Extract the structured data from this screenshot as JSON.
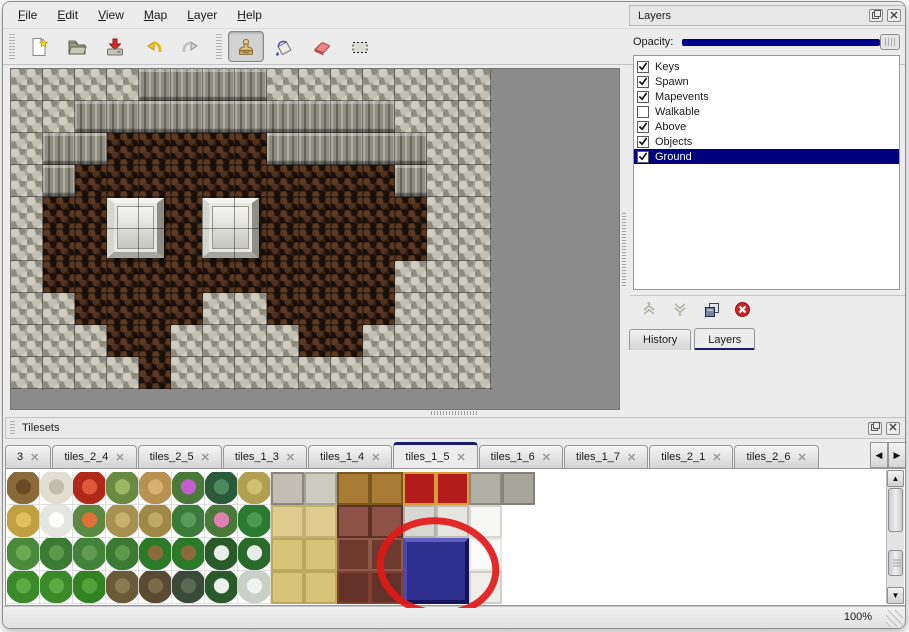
{
  "menu": {
    "items": [
      "File",
      "Edit",
      "View",
      "Map",
      "Layer",
      "Help"
    ]
  },
  "toolbar": {
    "buttons": [
      {
        "id": "new",
        "icon": "new-file-icon",
        "active": false
      },
      {
        "id": "open",
        "icon": "open-folder-icon",
        "active": false
      },
      {
        "id": "save",
        "icon": "save-icon",
        "active": false
      },
      {
        "id": "undo",
        "icon": "undo-icon",
        "active": false
      },
      {
        "id": "redo",
        "icon": "redo-icon",
        "active": false
      },
      {
        "id": "stamp",
        "icon": "stamp-tool-icon",
        "active": true
      },
      {
        "id": "fill",
        "icon": "fill-bucket-icon",
        "active": false
      },
      {
        "id": "eraser",
        "icon": "eraser-icon",
        "active": false
      },
      {
        "id": "select",
        "icon": "select-rect-icon",
        "active": false
      }
    ]
  },
  "map_view": {
    "tile_size": 32,
    "legend": {
      "R": "rock",
      "C": "cliff-face",
      "F": "cave-floor"
    },
    "grid": [
      "RRRRCCCCRRRRRRR",
      "RRCCCCCCCCCCRRR",
      "RCCFFFFFCCCCCRR",
      "RCFFFFFFFFFFCRR",
      "RFFFFFFFFFFFFRR",
      "RFFFFFFFFFFFFRR",
      "RFFFFFFFFFFFRRR",
      "RRFFFFRRFFFFRRR",
      "RRRFFRRRRFFRRRR",
      "RRRRFRRRRRRRRRR"
    ],
    "blocks": [
      {
        "x": 96,
        "y": 129,
        "w": 57,
        "h": 60
      },
      {
        "x": 191,
        "y": 129,
        "w": 57,
        "h": 60
      }
    ],
    "colors": {
      "rock": "#a5a396",
      "cliff": "#8f8d80",
      "floor": "#2e1c12",
      "canvas_bg": "#8b8b8b"
    }
  },
  "layers_panel": {
    "title": "Layers",
    "opacity_label": "Opacity:",
    "opacity_percent": 100,
    "slider_color": "#00008c",
    "selection_color": "#00007f",
    "layers": [
      {
        "name": "Keys",
        "checked": true,
        "selected": false
      },
      {
        "name": "Spawn",
        "checked": true,
        "selected": false
      },
      {
        "name": "Mapevents",
        "checked": true,
        "selected": false
      },
      {
        "name": "Walkable",
        "checked": false,
        "selected": false
      },
      {
        "name": "Above",
        "checked": true,
        "selected": false
      },
      {
        "name": "Objects",
        "checked": true,
        "selected": false
      },
      {
        "name": "Ground",
        "checked": true,
        "selected": true
      }
    ],
    "actions": [
      "move-layer-up",
      "move-layer-down",
      "duplicate-layer",
      "delete-layer"
    ],
    "dock_tabs": [
      {
        "label": "History",
        "active": false
      },
      {
        "label": "Layers",
        "active": true
      }
    ]
  },
  "tilesets_panel": {
    "title": "Tilesets",
    "tabs": [
      {
        "label": "3",
        "active": false
      },
      {
        "label": "tiles_2_4",
        "active": false
      },
      {
        "label": "tiles_2_5",
        "active": false
      },
      {
        "label": "tiles_1_3",
        "active": false
      },
      {
        "label": "tiles_1_4",
        "active": false
      },
      {
        "label": "tiles_1_5",
        "active": true
      },
      {
        "label": "tiles_1_6",
        "active": false
      },
      {
        "label": "tiles_1_7",
        "active": false
      },
      {
        "label": "tiles_2_1",
        "active": false
      },
      {
        "label": "tiles_2_6",
        "active": false
      }
    ],
    "palette": {
      "rows": [
        [
          "treeBare",
          "treeDead",
          "flowerRed",
          "stump",
          "trunk",
          "bushPurple",
          "fern",
          "plantSmall",
          "stoneCorner",
          "stonePale",
          "woodA",
          "woodA",
          "carpet",
          "carpet",
          "stoneCapA",
          "stoneCapB"
        ],
        [
          "hay",
          "snowMound",
          "flowersOrange",
          "dryGrass",
          "leaves",
          "lilyPad",
          "flowerPink",
          "lilyBig",
          "tatami",
          "tatami",
          "tableDark",
          "tableDark",
          "stoneMidA",
          "stoneMidB",
          "clothTop",
          "blank"
        ],
        [
          "sprouts",
          "bushA",
          "bushB",
          "bushA",
          "palmA",
          "palmA",
          "pineSnow",
          "palmB",
          "tatami2",
          "tatami2",
          "redBlock",
          "redBlock",
          "blueTL",
          "blueTR",
          "clothMid",
          "blank"
        ],
        [
          "coneA",
          "coneA",
          "coneB",
          "deadTwist",
          "deadTree",
          "darkTree",
          "pineTall",
          "deadSnow",
          "tatami2",
          "tatami2",
          "redBase",
          "redBase",
          "blueBL",
          "blueBR",
          "clothFringe",
          "blank"
        ]
      ],
      "legend": {
        "treeBare": {
          "style": "blob",
          "main": "#8a6a3a",
          "accent": "#6a4a22"
        },
        "treeDead": {
          "style": "blob",
          "main": "#e2ded2",
          "accent": "#c2beae"
        },
        "flowerRed": {
          "style": "blob",
          "main": "#b02818",
          "accent": "#e05838"
        },
        "stump": {
          "style": "blob",
          "main": "#6a8a42",
          "accent": "#9ab862"
        },
        "trunk": {
          "style": "blob",
          "main": "#b89050",
          "accent": "#d8b070"
        },
        "bushPurple": {
          "style": "blob",
          "main": "#4a7a3a",
          "accent": "#c060c8"
        },
        "fern": {
          "style": "blob",
          "main": "#2a5a3a",
          "accent": "#4a8a5a"
        },
        "plantSmall": {
          "style": "blob",
          "main": "#b0a050",
          "accent": "#d0c070"
        },
        "stoneCorner": {
          "style": "flat",
          "main": "#c2bfb2",
          "accent": "#8a887c"
        },
        "stonePale": {
          "style": "flat",
          "main": "#cdcabe",
          "accent": "#a5a296"
        },
        "woodA": {
          "style": "flat",
          "main": "#a87c34",
          "accent": "#7c5820"
        },
        "carpet": {
          "style": "flat",
          "main": "#b41c1c",
          "accent": "#d89c3c"
        },
        "stoneCapA": {
          "style": "flat",
          "main": "#b2afa4",
          "accent": "#8c8a80"
        },
        "stoneCapB": {
          "style": "flat",
          "main": "#a8a59a",
          "accent": "#848278"
        },
        "hay": {
          "style": "blob",
          "main": "#c0a040",
          "accent": "#e0c060"
        },
        "snowMound": {
          "style": "blob",
          "main": "#e6e6e0",
          "accent": "#ffffff"
        },
        "flowersOrange": {
          "style": "blob",
          "main": "#5a8a42",
          "accent": "#e07038"
        },
        "dryGrass": {
          "style": "blob",
          "main": "#a89050",
          "accent": "#c8b070"
        },
        "leaves": {
          "style": "blob",
          "main": "#a08848",
          "accent": "#c0a868"
        },
        "lilyPad": {
          "style": "blob",
          "main": "#3a7a3a",
          "accent": "#5a9a5a"
        },
        "flowerPink": {
          "style": "blob",
          "main": "#4a7a3a",
          "accent": "#e080b0"
        },
        "lilyBig": {
          "style": "blob",
          "main": "#2a7a32",
          "accent": "#4a9a52"
        },
        "tatami": {
          "style": "flat",
          "main": "#ddcc8e",
          "accent": "#c2b070"
        },
        "tableDark": {
          "style": "flat",
          "main": "#8c5248",
          "accent": "#5e3028"
        },
        "stoneMidA": {
          "style": "flat",
          "main": "#d8d8d2",
          "accent": "#b0b0aa"
        },
        "stoneMidB": {
          "style": "flat",
          "main": "#e6e6e0",
          "accent": "#bebeb8"
        },
        "clothTop": {
          "style": "flat",
          "main": "#f6f6f2",
          "accent": "#d8d8d2"
        },
        "blank": {
          "style": "flat",
          "main": "#ffffff",
          "accent": "#ffffff"
        },
        "sprouts": {
          "style": "blob",
          "main": "#4a8a3a",
          "accent": "#6aaa52"
        },
        "bushA": {
          "style": "blob",
          "main": "#3a7a32",
          "accent": "#5a9a4a"
        },
        "bushB": {
          "style": "blob",
          "main": "#42823a",
          "accent": "#629a52"
        },
        "palmA": {
          "style": "blob",
          "main": "#2a7a2a",
          "accent": "#8a6a3a"
        },
        "palmB": {
          "style": "blob",
          "main": "#2a6a2a",
          "accent": "#e8ece8"
        },
        "pineSnow": {
          "style": "blob",
          "main": "#2a5a2a",
          "accent": "#e8f0e8"
        },
        "tatami2": {
          "style": "flat",
          "main": "#d8c478",
          "accent": "#bca85c"
        },
        "redBlock": {
          "style": "flat",
          "main": "#6e3a30",
          "accent": "#8e5a4c"
        },
        "blueTL": {
          "style": "bevel",
          "main": "#2e2e8e",
          "accent": "#5252b2"
        },
        "blueTR": {
          "style": "bevel",
          "main": "#2e2e8e",
          "accent": "#5252b2"
        },
        "blueBL": {
          "style": "bevel",
          "main": "#2e2e8e",
          "accent": "#5252b2"
        },
        "blueBR": {
          "style": "bevel",
          "main": "#2e2e8e",
          "accent": "#5252b2"
        },
        "clothMid": {
          "style": "flat",
          "main": "#fbfbf9",
          "accent": "#e8e8e2"
        },
        "coneA": {
          "style": "blob",
          "main": "#3a8a2a",
          "accent": "#5aaa42"
        },
        "coneB": {
          "style": "blob",
          "main": "#328222",
          "accent": "#52a23a"
        },
        "deadTwist": {
          "style": "blob",
          "main": "#6a5a38",
          "accent": "#8a7a52"
        },
        "deadTree": {
          "style": "blob",
          "main": "#5a4a32",
          "accent": "#7a6a4a"
        },
        "darkTree": {
          "style": "blob",
          "main": "#3a4a38",
          "accent": "#5a6a52"
        },
        "pineTall": {
          "style": "blob",
          "main": "#2a5a2a",
          "accent": "#eaf0ea"
        },
        "deadSnow": {
          "style": "blob",
          "main": "#c8d0c8",
          "accent": "#f0f4f0"
        },
        "redBase": {
          "style": "flat",
          "main": "#623228",
          "accent": "#823f32"
        },
        "clothFringe": {
          "style": "flat",
          "main": "#eeeee8",
          "accent": "#cfcfc8"
        }
      }
    },
    "annotation": {
      "shape": "ellipse",
      "color": "#e21818",
      "cx": 433,
      "cy": 152,
      "rx": 58,
      "ry": 46,
      "rotation": 8,
      "stroke_width": 7
    }
  },
  "status_bar": {
    "zoom_level": "100%"
  },
  "accent_colors": {
    "tab_active": "#1b1b6f",
    "selection": "#00007f",
    "annotation_red": "#e21818"
  }
}
